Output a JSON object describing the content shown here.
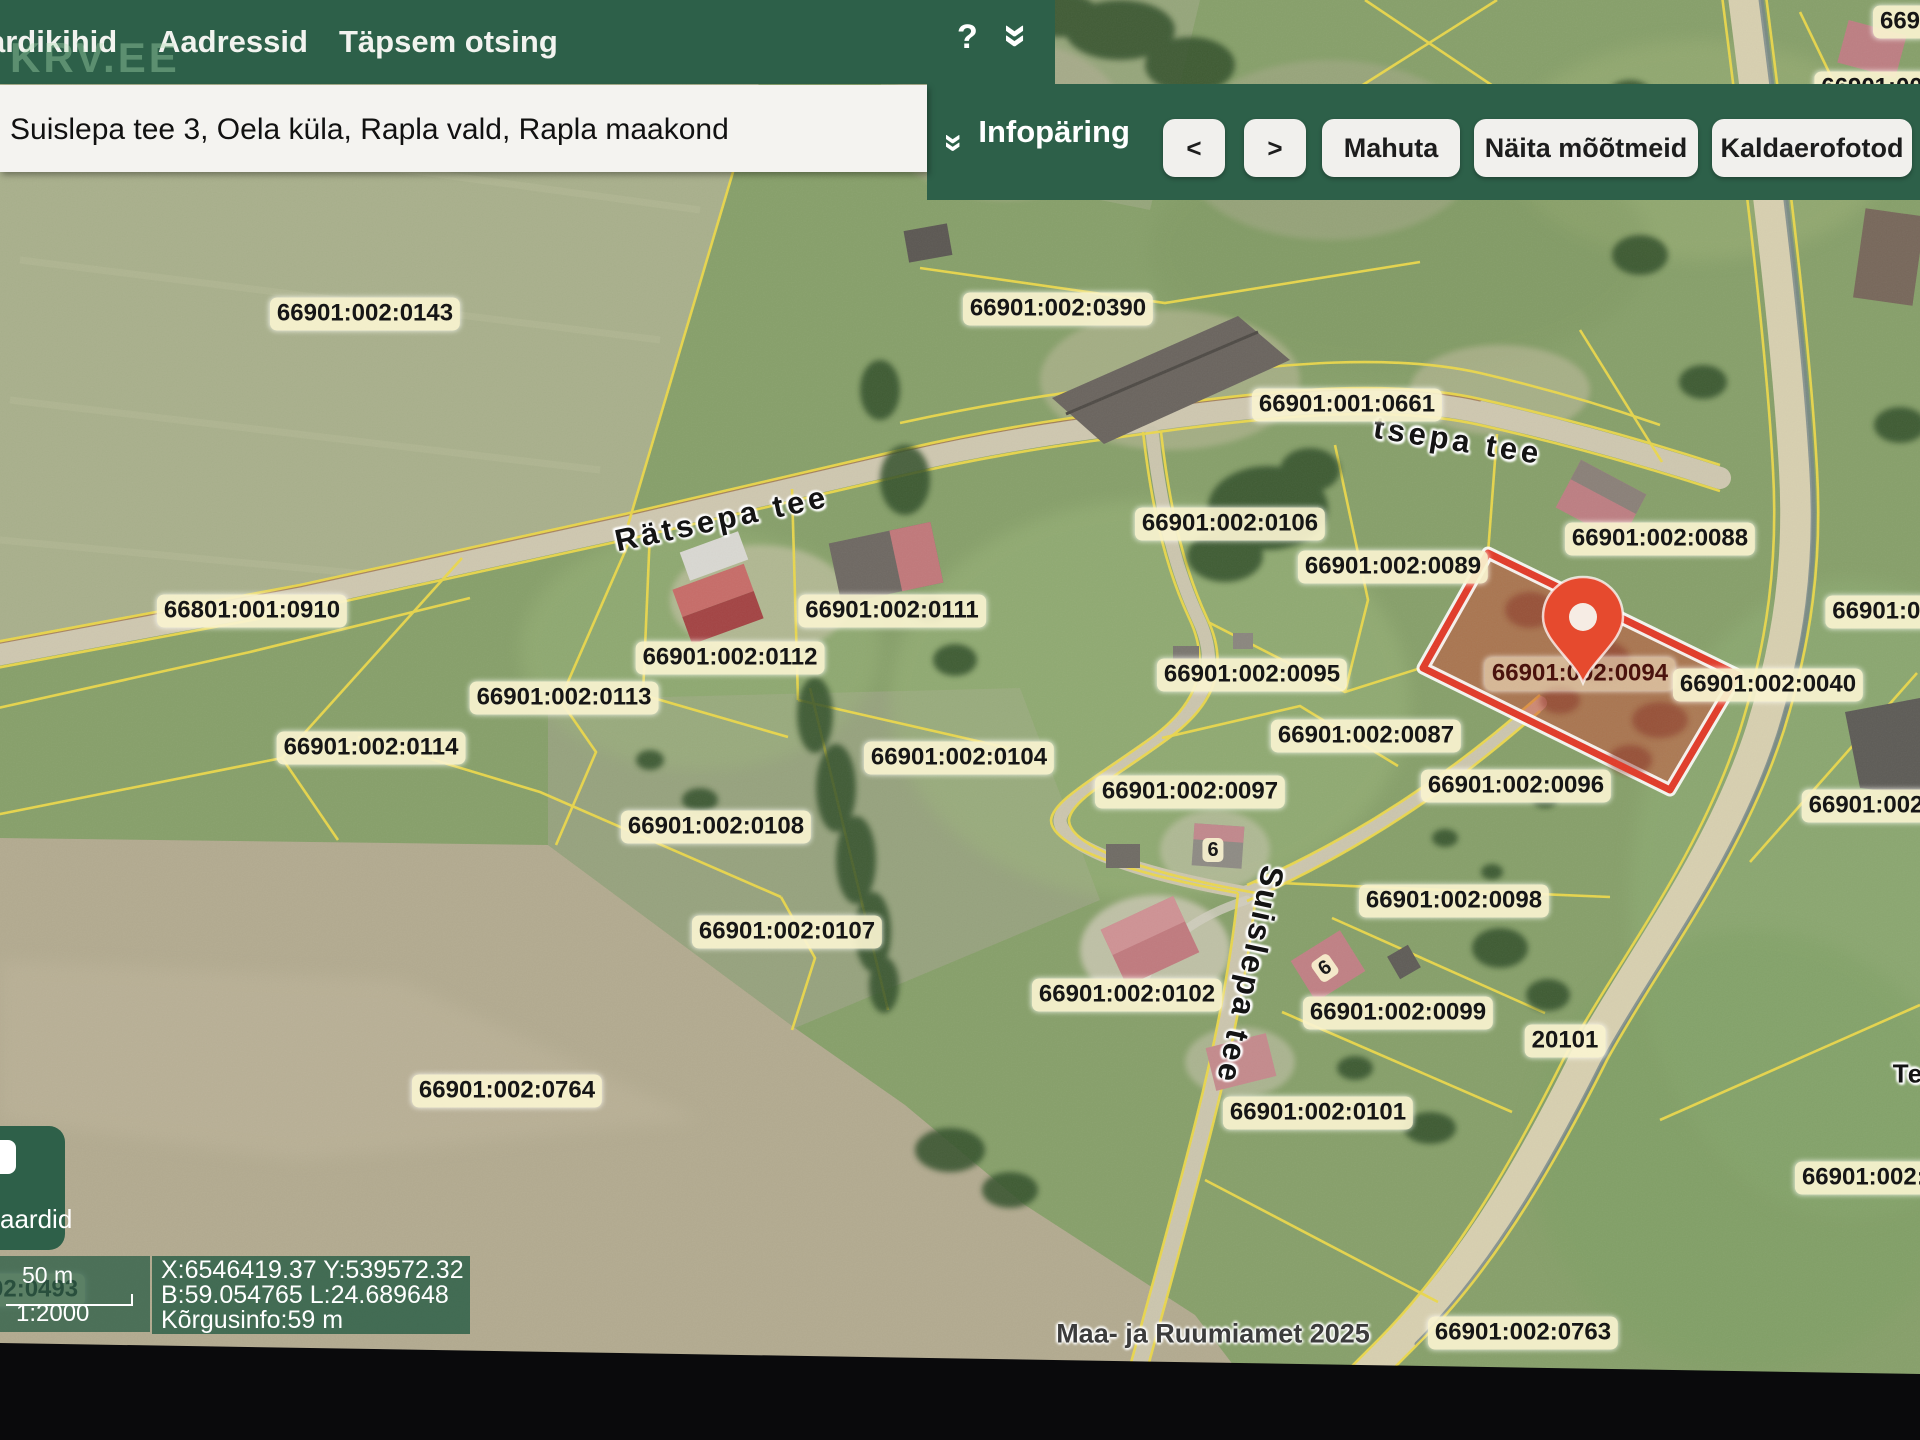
{
  "nav": {
    "menu_items": [
      "ardikihid",
      "Aadressid",
      "Täpsem otsing"
    ],
    "help_label": "?",
    "watermark": "KRV.EE"
  },
  "search": {
    "address_value": "Suislepa tee 3, Oela küla, Rapla vald, Rapla maakond"
  },
  "toolbar": {
    "panel_label": "Infopäring",
    "prev_label": "<",
    "next_label": ">",
    "buttons": [
      "Mahuta",
      "Näita mõõtmeid",
      "Kaldaerofotod"
    ]
  },
  "map": {
    "highlighted_parcel": "66901:002:0094",
    "attribution": "Maa- ja Ruumiamet 2025",
    "colors": {
      "chrome_green": "#2d6049",
      "cadastral_yellow": "#ecd94b",
      "highlight_red": "#e23a28",
      "pin_orange": "#e64a2e",
      "badge_cream": "#f9f3d0"
    },
    "parcel_labels": [
      {
        "t": "66901:002:0143",
        "x": 365,
        "y": 314
      },
      {
        "t": "66901:002:0390",
        "x": 1058,
        "y": 309
      },
      {
        "t": "66901:001:0661",
        "x": 1347,
        "y": 405
      },
      {
        "t": "66901:002:0106",
        "x": 1230,
        "y": 524
      },
      {
        "t": "66901:002:0089",
        "x": 1393,
        "y": 567
      },
      {
        "t": "66901:002:0088",
        "x": 1660,
        "y": 539
      },
      {
        "t": "66901:002:0111",
        "x": 892,
        "y": 611
      },
      {
        "t": "66901:002:0112",
        "x": 730,
        "y": 658
      },
      {
        "t": "66801:001:0910",
        "x": 252,
        "y": 611
      },
      {
        "t": "66901:002:0113",
        "x": 564,
        "y": 698
      },
      {
        "t": "66901:002:0114",
        "x": 371,
        "y": 748
      },
      {
        "t": "66901:002:0095",
        "x": 1252,
        "y": 675
      },
      {
        "t": "66901:002:0094",
        "x": 1580,
        "y": 674,
        "cls": "on-red"
      },
      {
        "t": "66901:002:0040",
        "x": 1768,
        "y": 685
      },
      {
        "t": "66901:00",
        "x": 1883,
        "y": 612
      },
      {
        "t": "66901:002:0087",
        "x": 1366,
        "y": 736
      },
      {
        "t": "66901:002:0104",
        "x": 959,
        "y": 758
      },
      {
        "t": "66901:002:0097",
        "x": 1190,
        "y": 792
      },
      {
        "t": "66901:002:0096",
        "x": 1516,
        "y": 786
      },
      {
        "t": "66901:002:",
        "x": 1870,
        "y": 806
      },
      {
        "t": "66901:002:0108",
        "x": 716,
        "y": 827
      },
      {
        "t": "66901:002:0098",
        "x": 1454,
        "y": 901
      },
      {
        "t": "66901:002:0107",
        "x": 787,
        "y": 932
      },
      {
        "t": "66901:002:0102",
        "x": 1127,
        "y": 995
      },
      {
        "t": "66901:002:0099",
        "x": 1398,
        "y": 1013
      },
      {
        "t": "66901:002:0101",
        "x": 1318,
        "y": 1113
      },
      {
        "t": "66901:002:0764",
        "x": 507,
        "y": 1091
      },
      {
        "t": "66901:002:0",
        "x": 1870,
        "y": 1178
      },
      {
        "t": "20101",
        "x": 1565,
        "y": 1041
      },
      {
        "t": "66901:002:0763",
        "x": 1523,
        "y": 1333
      },
      {
        "t": "669",
        "x": 1900,
        "y": 22
      },
      {
        "t": "66901:00",
        "x": 1872,
        "y": 88
      }
    ],
    "road_labels": [
      {
        "t": "Rätsepa tee",
        "x": 722,
        "y": 519,
        "rot": -12,
        "size": 31,
        "ls": 4
      },
      {
        "t": "tsepa tee",
        "x": 1458,
        "y": 441,
        "rot": 9,
        "size": 31,
        "ls": 4
      },
      {
        "t": "Suislepa tee",
        "x": 1250,
        "y": 975,
        "rot": 102,
        "size": 32,
        "ls": 3
      },
      {
        "t": "Te",
        "x": 1908,
        "y": 1074,
        "rot": 0,
        "size": 26,
        "ls": 1
      }
    ],
    "house_numbers": [
      {
        "t": "6",
        "x": 1213,
        "y": 850,
        "rot": 0
      },
      {
        "t": "6",
        "x": 1325,
        "y": 968,
        "rot": -35
      }
    ],
    "ghost_parcel_label": {
      "t": "66901:002:0493",
      "x": -10,
      "y": 1290
    }
  },
  "status": {
    "layers_button_label": "aardid",
    "scale_distance": "50 m",
    "scale_ratio": "1:2000",
    "coord_line1": "X:6546419.37 Y:539572.32",
    "coord_line2": "B:59.054765 L:24.689648",
    "coord_line3": "Kõrgusinfo:59 m"
  }
}
